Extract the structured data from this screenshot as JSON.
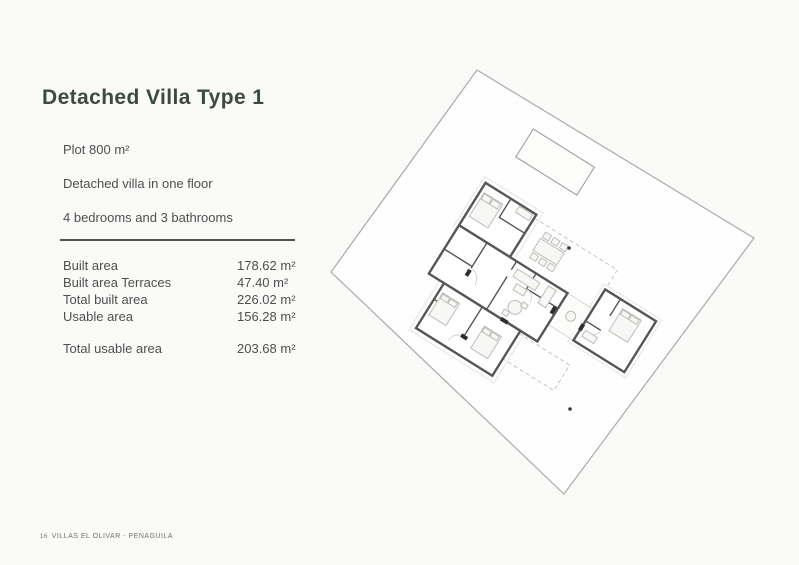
{
  "page": {
    "title": "Detached Villa Type 1"
  },
  "specs": {
    "lines": [
      "Plot 800 m²",
      "Detached villa in one floor",
      "4 bedrooms and 3 bathrooms"
    ]
  },
  "areas": {
    "rows": [
      {
        "label": "Built area",
        "value": "178.62 m²"
      },
      {
        "label": "Built area Terraces",
        "value": "47.40 m²"
      },
      {
        "label": "Total built area",
        "value": "226.02 m²"
      },
      {
        "label": "Usable area",
        "value": "156.28 m²"
      }
    ],
    "total": {
      "label": "Total usable area",
      "value": "203.68 m²"
    }
  },
  "footer": {
    "page_number": "16",
    "project": "VILLAS EL OLIVAR - PENAGUILA"
  },
  "colors": {
    "title-text": "#3d4a41",
    "body-text": "#4f4f4f",
    "divider": "#55524b",
    "plot-line": "#a9a9a7",
    "wall": "#565656",
    "furniture": "#bdbdb9",
    "page-bg": "#fafaf8"
  }
}
